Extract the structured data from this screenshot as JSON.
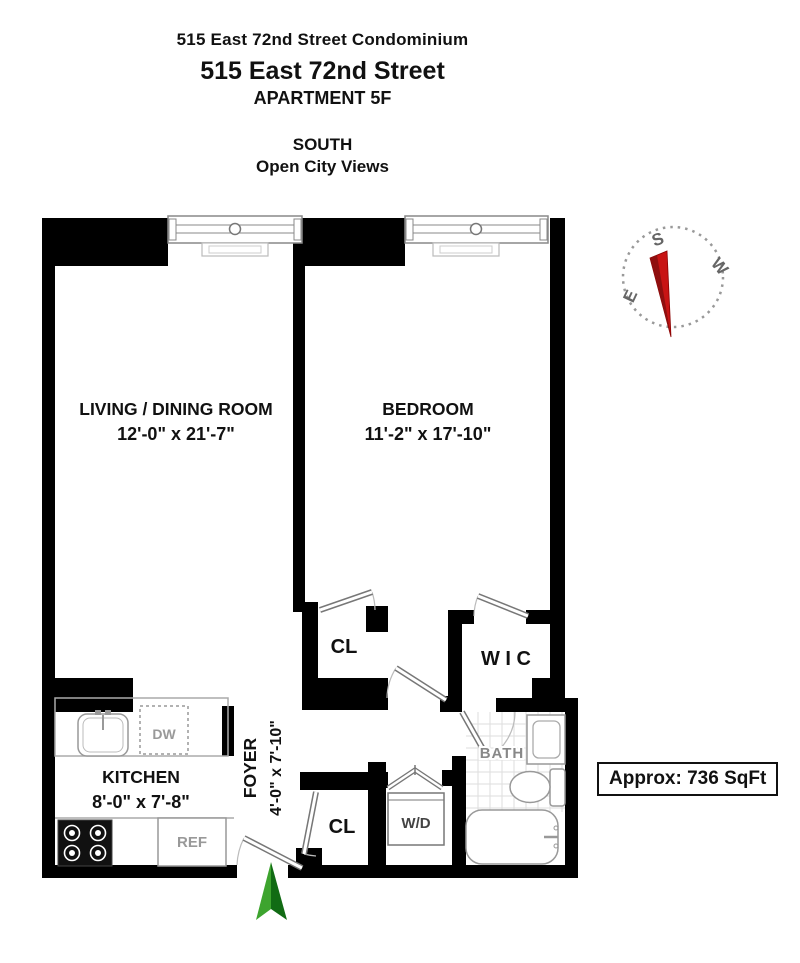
{
  "header": {
    "building": "515 East 72nd Street Condominium",
    "address": "515 East 72nd Street",
    "unit": "APARTMENT 5F",
    "exposure": "SOUTH",
    "view": "Open City Views"
  },
  "plan": {
    "living": {
      "name": "LIVING / DINING ROOM",
      "dims": "12'-0\" x 21'-7\""
    },
    "bedroom": {
      "name": "BEDROOM",
      "dims": "11'-2\" x 17'-10\""
    },
    "kitchen": {
      "name": "KITCHEN",
      "dims": "8'-0\" x 7'-8\""
    },
    "foyer": {
      "name": "FOYER",
      "dims": "4'-0\" x 7'-10\""
    },
    "bath": {
      "name": "BATH"
    },
    "wic": {
      "name": "W I C"
    },
    "bedroom_closet": {
      "name": "CL"
    },
    "foyer_closet": {
      "name": "CL"
    },
    "washer_dryer": {
      "name": "W/D"
    },
    "dishwasher": {
      "name": "DW"
    },
    "refrigerator": {
      "name": "REF"
    }
  },
  "compass": {
    "south": "S",
    "west": "W",
    "east": "E"
  },
  "area": {
    "label": "Approx: 736 SqFt"
  },
  "colors": {
    "wall": "#000000",
    "needle": "#c81414",
    "arrow_light": "#3da42e",
    "arrow_dark": "#116b14"
  }
}
